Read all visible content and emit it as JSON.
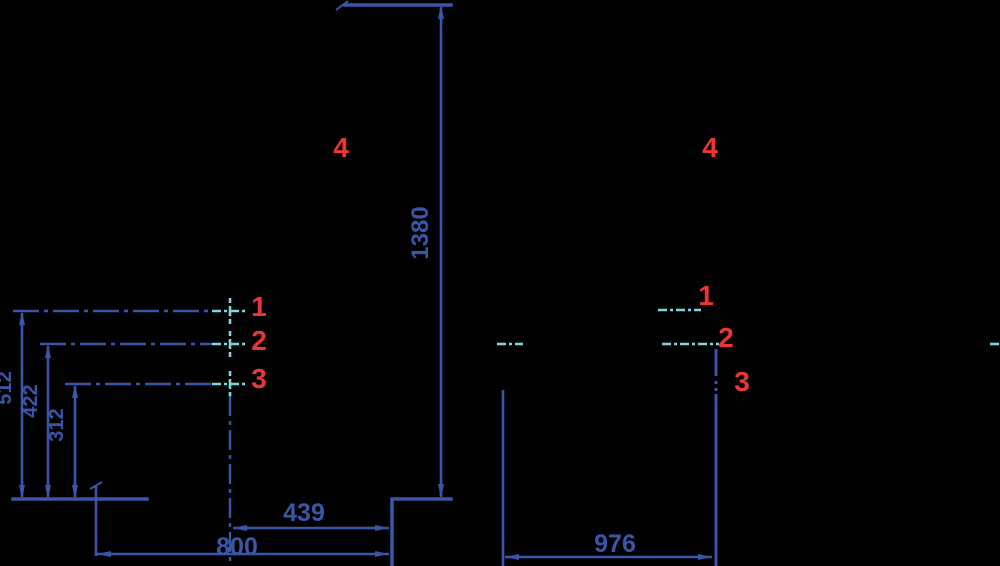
{
  "drawing": {
    "kind": "dimensioned technical drawing, two views",
    "colors": {
      "background": "#000000",
      "line_blue": "#3A56A8",
      "centerline_cyan": "#7FD6DB",
      "marker_red": "#E93832"
    },
    "front_view": {
      "dim_total_height": "1380",
      "dim_pos1_height": "512",
      "dim_pos2_height": "422",
      "dim_pos3_height": "312",
      "dim_step_width": "439",
      "dim_total_width": "800",
      "markers": {
        "pos1": "1",
        "pos2": "2",
        "pos3": "3",
        "pos4": "4"
      }
    },
    "side_view": {
      "dim_depth": "976",
      "markers": {
        "pos1": "1",
        "pos2": "2",
        "pos3": "3",
        "pos4": "4"
      }
    }
  }
}
